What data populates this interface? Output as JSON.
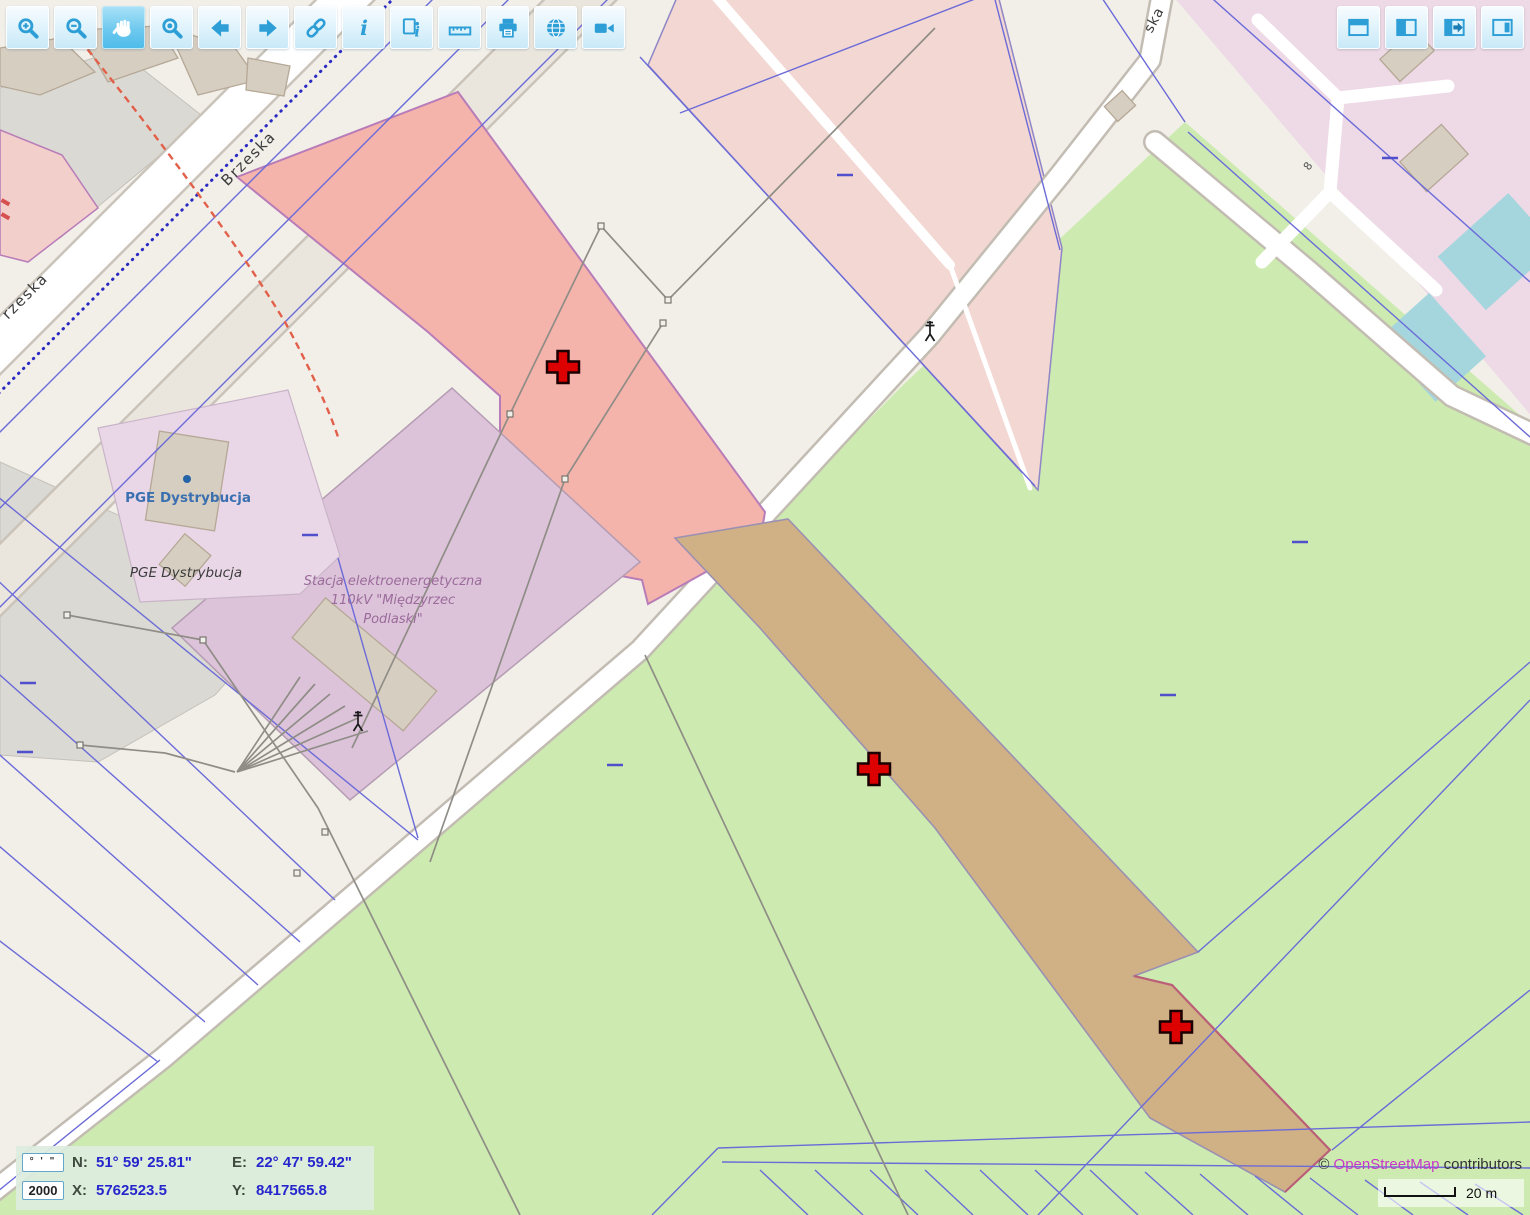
{
  "toolbar_left": {
    "buttons": [
      {
        "name": "zoom-in",
        "icon": "magnifier-plus-icon",
        "active": false
      },
      {
        "name": "zoom-out",
        "icon": "magnifier-minus-icon",
        "active": false
      },
      {
        "name": "pan",
        "icon": "hand-icon",
        "active": true
      },
      {
        "name": "zoom-window",
        "icon": "magnifier-window-icon",
        "active": false
      },
      {
        "name": "previous-view",
        "icon": "arrow-left-icon",
        "active": false
      },
      {
        "name": "next-view",
        "icon": "arrow-right-icon",
        "active": false
      },
      {
        "name": "link",
        "icon": "chain-link-icon",
        "active": false
      },
      {
        "name": "info",
        "icon": "info-icon",
        "active": false
      },
      {
        "name": "identify",
        "icon": "identify-page-icon",
        "active": false
      },
      {
        "name": "measure",
        "icon": "ruler-icon",
        "active": false
      },
      {
        "name": "print",
        "icon": "printer-icon",
        "active": false
      },
      {
        "name": "overview",
        "icon": "globe-icon",
        "active": false
      },
      {
        "name": "video",
        "icon": "video-camera-icon",
        "active": false
      }
    ]
  },
  "toolbar_right": {
    "buttons": [
      {
        "name": "toggle-top-panel",
        "icon": "panel-top-icon"
      },
      {
        "name": "toggle-left-panel",
        "icon": "panel-left-icon"
      },
      {
        "name": "collapse-panel",
        "icon": "panel-arrow-right-icon"
      },
      {
        "name": "toggle-right-panel",
        "icon": "panel-right-icon"
      }
    ]
  },
  "status_panel": {
    "dms_button_label": "° ' \"",
    "scale_value": "2000",
    "n_label": "N:",
    "n_value": "51° 59' 25.81\"",
    "e_label": "E:",
    "e_value": "22° 47' 59.42\"",
    "x_label": "X:",
    "x_value": "5762523.5",
    "y_label": "Y:",
    "y_value": "8417565.8"
  },
  "attribution": {
    "copyright": "©",
    "link": "OpenStreetMap",
    "suffix": "contributors"
  },
  "scalebar": {
    "label": "20 m"
  },
  "map": {
    "street_labels": {
      "brzeska": "Brzeska",
      "brzeska_cut": "rzeska",
      "top_right_cut": "ska",
      "house_number": "8"
    },
    "poi_labels": {
      "pge_point": "PGE Dystrybucja",
      "pge_area": "PGE Dystrybucja"
    },
    "substation_label": {
      "line1": "Stacja elektroenergetyczna",
      "line2": "110kV \"Międzyrzec",
      "line3": "Podlaski\""
    },
    "markers": {
      "type": "red-cross",
      "count": 3
    },
    "colors": {
      "land": "#f2efe9",
      "meadow": "#cdebb0",
      "selected_parcel": "#f4b4ac",
      "farmland": "#cfb185",
      "industrial": "#dcc3da",
      "cadastre_line": "#6b6bd8",
      "marker": "#dd0000"
    }
  }
}
